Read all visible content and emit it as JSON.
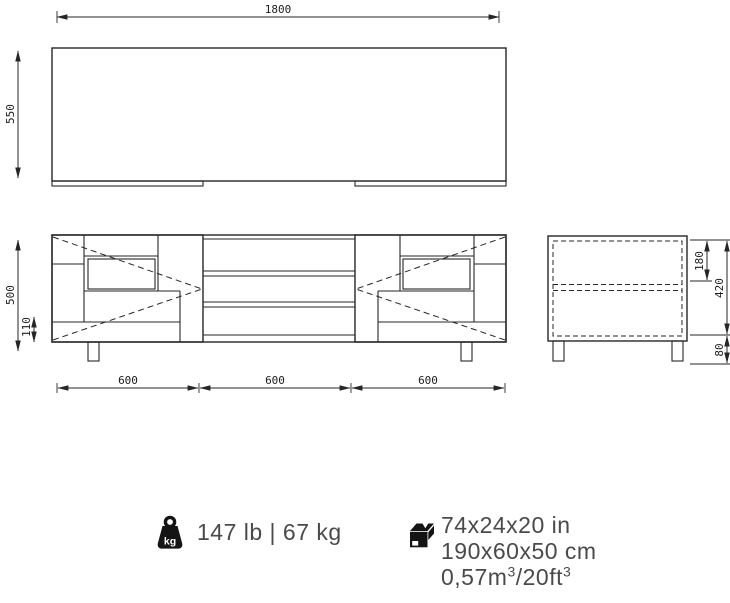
{
  "views": {
    "top": {
      "width": "1800",
      "depth": "550"
    },
    "front": {
      "height": "500",
      "plinth": "110",
      "segments": [
        "600",
        "600",
        "600"
      ]
    },
    "side": {
      "top_shelf": "180",
      "inner_height": "420",
      "base_height": "80"
    }
  },
  "info": {
    "weight": {
      "icon": "kettlebell-kg-icon",
      "unit_mark": "kg",
      "label": "147 lb | 67 kg"
    },
    "package": {
      "icon": "cardboard-box-icon",
      "line1": "74x24x20 in",
      "line2": "190x60x50 cm",
      "volume": {
        "base": "0,57m",
        "sup1": "3",
        "slash": "/20ft",
        "sup2": "3"
      }
    }
  },
  "colors": {
    "line": "#262626",
    "dim_text": "#1c1c1c",
    "info_text": "#4a4a4a",
    "background": "#ffffff"
  }
}
